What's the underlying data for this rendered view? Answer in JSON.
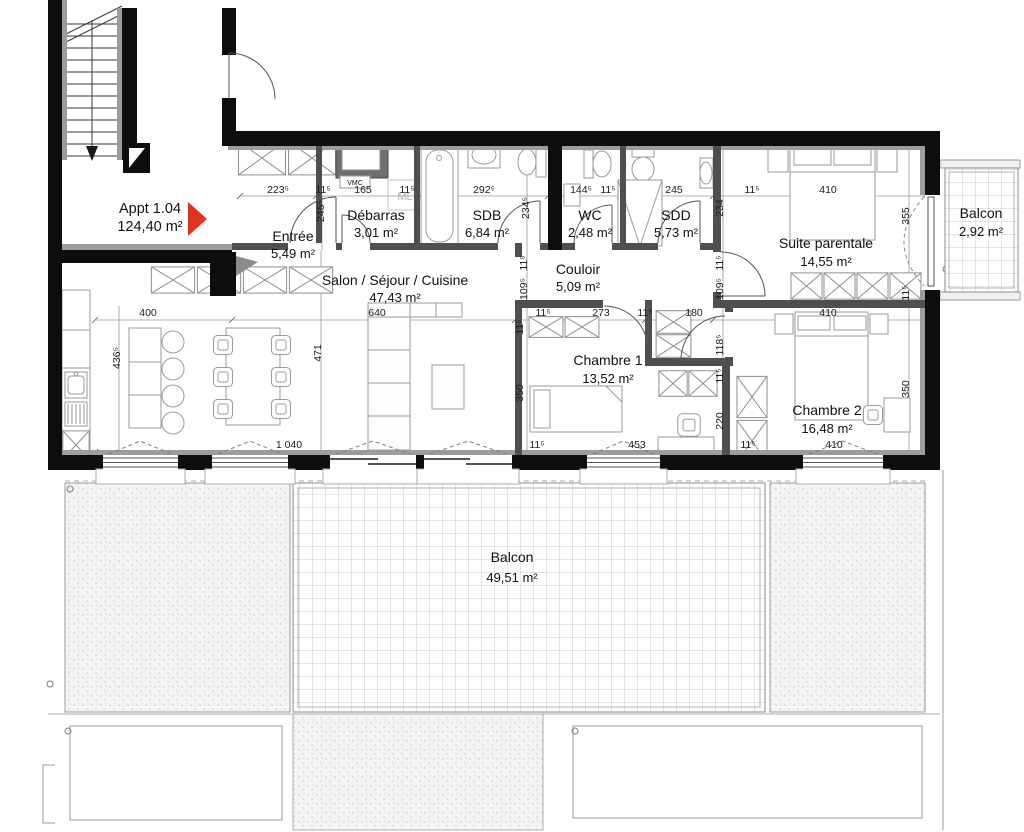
{
  "apartment": {
    "name": "Appt 1.04",
    "area": "124,40 m²"
  },
  "rooms": [
    {
      "name": "Entrée",
      "area": "5,49 m²"
    },
    {
      "name": "Débarras",
      "area": "3,01 m²"
    },
    {
      "name": "SDB",
      "area": "6,84 m²"
    },
    {
      "name": "WC",
      "area": "2,48 m²"
    },
    {
      "name": "SDD",
      "area": "5,73 m²"
    },
    {
      "name": "Couloir",
      "area": "5,09 m²"
    },
    {
      "name": "Salon / Séjour / Cuisine",
      "area": "47,43 m²"
    },
    {
      "name": "Chambre 1",
      "area": "13,52 m²"
    },
    {
      "name": "Chambre 2",
      "area": "16,48 m²"
    },
    {
      "name": "Suite parentale",
      "area": "14,55 m²"
    },
    {
      "name": "Balcon",
      "area": "2,92 m²"
    },
    {
      "name": "Balcon",
      "area": "49,51 m²"
    }
  ],
  "labels": {
    "vmc": "VMC",
    "ml": "ML"
  },
  "accent_color": "#E0321F",
  "dims": [
    "223⁵",
    "11⁵",
    "165",
    "11⁵",
    "292⁵",
    "144⁵",
    "11⁵",
    "245",
    "11⁵",
    "410",
    "245⁵",
    "234⁵",
    "234",
    "355",
    "11⁵",
    "109⁵",
    "11⁵",
    "109⁵",
    "11⁵",
    "400",
    "640",
    "11⁵",
    "273",
    "11⁵",
    "180",
    "410",
    "11⁵",
    "118⁵",
    "11⁵",
    "220",
    "436⁵",
    "471",
    "350",
    "350",
    "1 040",
    "11⁵",
    "453",
    "11⁵",
    "410"
  ]
}
